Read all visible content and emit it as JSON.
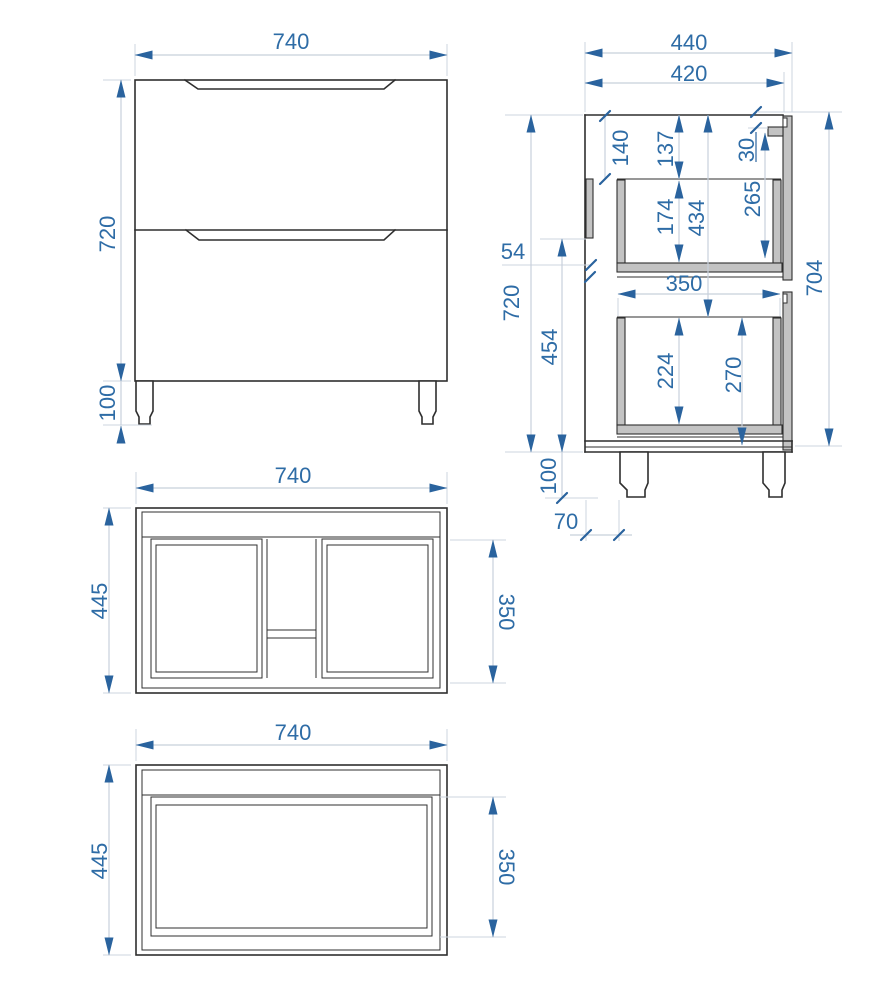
{
  "drawing": {
    "type": "furniture-technical-drawing",
    "subject": "two-drawer vanity cabinet with legs",
    "units": "mm",
    "colors": {
      "outline": "#2f2f2f",
      "dimension_text": "#2e6ca6",
      "dimension_arrow": "#2a639e",
      "dimension_line": "#c7d0db",
      "panel_fill": "#c3c3c3",
      "background": "#ffffff"
    },
    "views": {
      "front": {
        "width": "740",
        "height": "720",
        "leg_height": "100"
      },
      "side": {
        "overall_depth": "440",
        "carcase_depth": "420",
        "top_rail_height": "140",
        "top_to_drawer": "137",
        "rail_offset": "30",
        "upper_drawer_inner_height": "174",
        "top_to_lower_drawer": "434",
        "upper_front_inner_height": "265",
        "back_rail_gap": "54",
        "carcase_height": "720",
        "lower_section_height": "454",
        "drawer_inner_depth": "350",
        "lower_drawer_inner_height": "224",
        "lower_front_height": "270",
        "overall_side_height": "704",
        "leg_height": "100",
        "leg_setback": "70"
      },
      "top": {
        "width": "740",
        "depth": "445",
        "inner_depth": "350"
      },
      "bottom": {
        "width": "740",
        "depth": "445",
        "inner_depth": "350"
      }
    }
  }
}
